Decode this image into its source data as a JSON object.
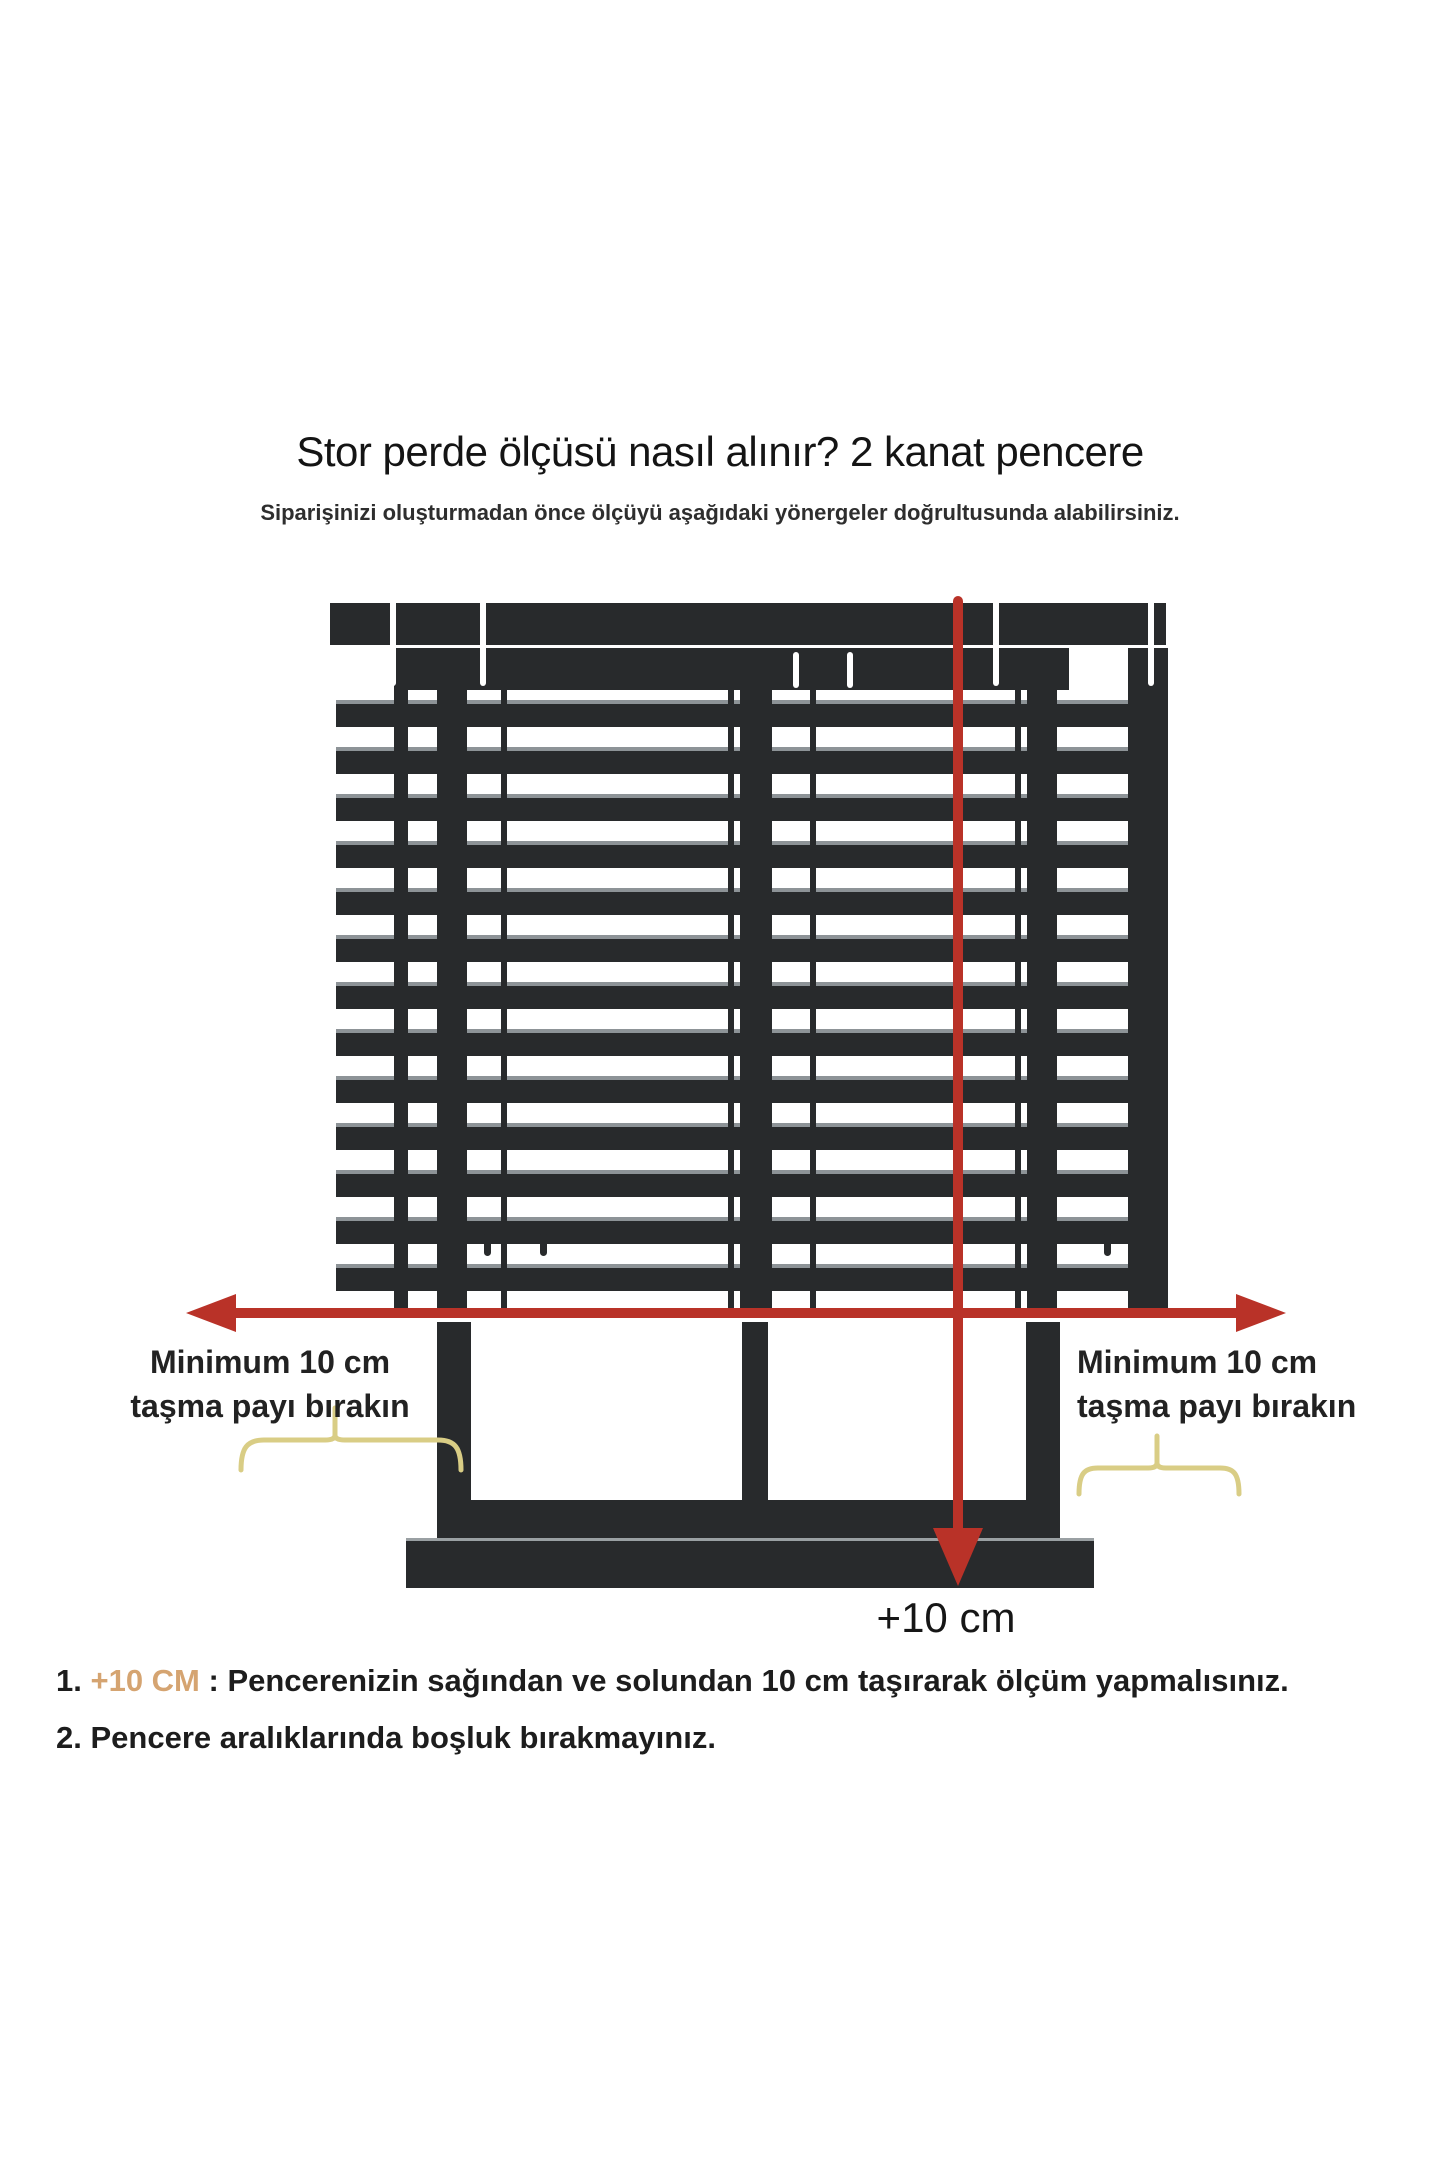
{
  "title": "Stor perde ölçüsü nasıl alınır? 2 kanat pencere",
  "subtitle": "Siparişinizi oluşturmadan önce ölçüyü aşağıdaki yönergeler doğrultusunda alabilirsiniz.",
  "diagram": {
    "left_label": {
      "line1": "Minimum 10 cm",
      "line2": "taşma payı bırakın"
    },
    "right_label": {
      "line1": "Minimum 10 cm",
      "line2": "taşma payı bırakın"
    },
    "bottom_arrow_label": "+10 cm",
    "colors": {
      "blind_dark": "#282a2c",
      "slat_highlight": "#8d9397",
      "arrow_red": "#b93228",
      "brace_yellow": "#d9cd85",
      "note_highlight": "#d5a471"
    }
  },
  "notes": [
    {
      "number": "1.",
      "highlight": " +10 CM",
      "separator": " : ",
      "text": "Pencerenizin sağından ve solundan 10 cm taşırarak ölçüm yapmalısınız."
    },
    {
      "number": "2.",
      "highlight": "",
      "separator": " ",
      "text": "Pencere aralıklarında boşluk bırakmayınız."
    }
  ]
}
